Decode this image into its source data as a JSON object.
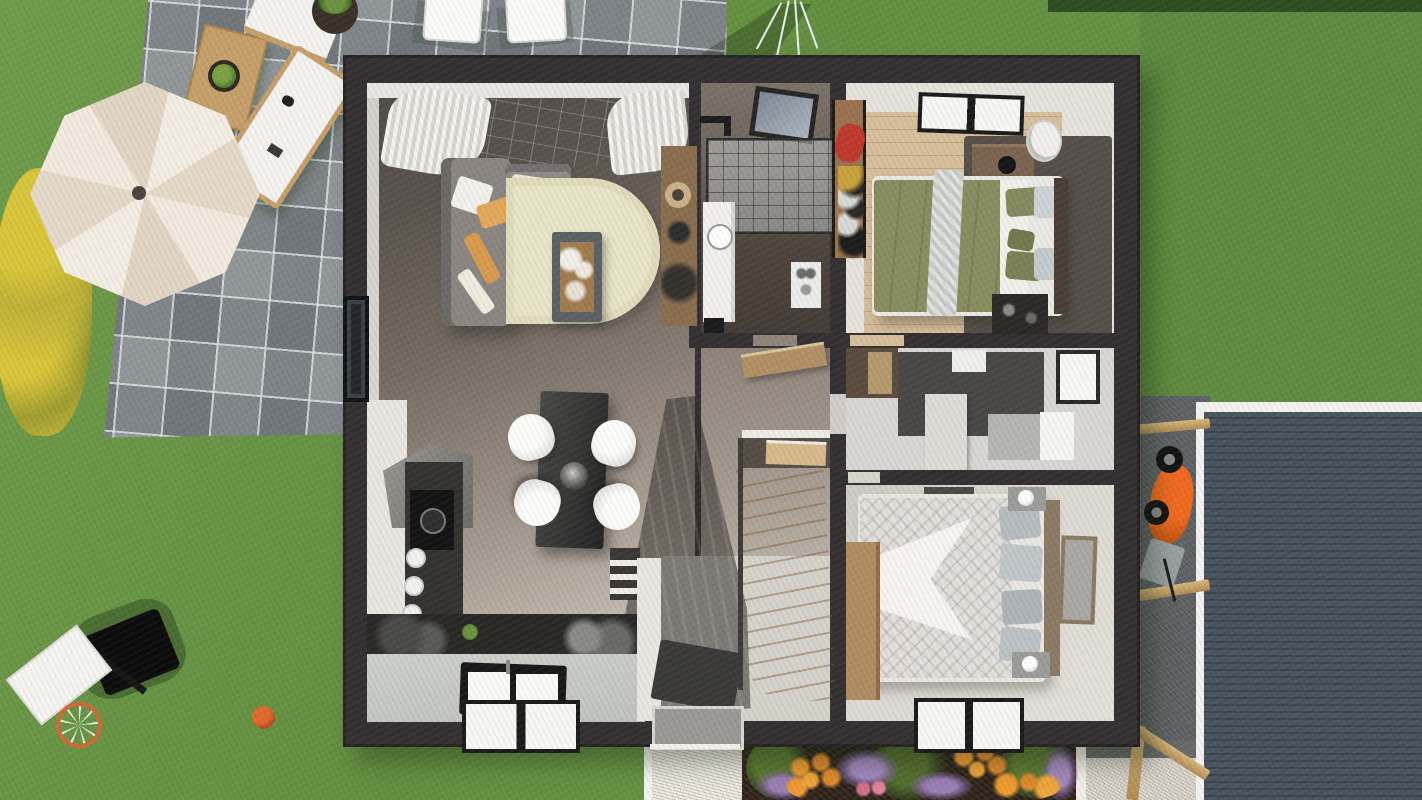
{
  "scene": {
    "type": "3d-floorplan-render",
    "view": "top-down",
    "palette": {
      "grass": "#6a974a",
      "hedge": "#2f4d22",
      "paver_gray": "#919699",
      "paver_grout": "#e1e5e8",
      "umbrella_cream": "#f2eade",
      "garden_wood": "#c6a06b",
      "bench_white": "#f4f3f0",
      "wall_charcoal": "#353132",
      "floor_dark_taupe": "#544e49",
      "floor_light": "#d2cdc3",
      "wood_floor": "#d7bf9b",
      "rug_beige": "#e9e5c8",
      "sofa_gray": "#8b8681",
      "cushion_orange": "#e3a85c",
      "bed_olive": "#8a8d60",
      "bed_white": "#e9e7e2",
      "pillow_gray_blue": "#c0c6c9",
      "counter_dark": "#2b2927",
      "countertop_gray": "#c4c7c2",
      "stairs_wood": "#e5cda6",
      "roof_slate": "#46505a",
      "driveway_gray": "#5e6163",
      "gravel_light": "#d6d0c6",
      "path_white": "#ece8df",
      "soil_brown": "#382c21",
      "flower_orange": "#e08a2e",
      "flower_purple": "#9a7fb5",
      "flower_yellow": "#d9c53a",
      "leaf_green": "#55702f",
      "wheelbarrow_orange": "#ef6a1f",
      "basketball_orange": "#d4622a"
    },
    "exterior_objects": [
      "paver-patio",
      "cream-parasol",
      "wooden-garden-table",
      "potted-plant",
      "white-garden-bench",
      "white-garden-bench-diagonal",
      "white-patio-chairs",
      "rotary-clothes-dryer",
      "yellow-flower-bush",
      "lawn",
      "basketball-hoop",
      "basketball",
      "hedge",
      "gravel-driveway",
      "timber-carport-beams",
      "corrugated-slate-roof",
      "orange-wheelbarrow",
      "white-gravel-path",
      "flower-bed-orange-purple"
    ],
    "house_rooms": [
      {
        "name": "living-room",
        "objects": [
          "glass-window-wall",
          "curtains",
          "corner-sofa",
          "cushions",
          "oval-rug",
          "coffee-table",
          "sideboard",
          "side-window"
        ]
      },
      {
        "name": "bathroom",
        "objects": [
          "skylight",
          "walk-in-shower",
          "shower-head",
          "vanity-basin",
          "appliance",
          "dark-mat"
        ]
      },
      {
        "name": "bedroom-1",
        "objects": [
          "window",
          "open-wardrobe",
          "red-clothes",
          "shoes",
          "dresser",
          "laundry-basket",
          "double-bed-olive",
          "gray-throw",
          "pillows",
          "dark-rug",
          "desk"
        ]
      },
      {
        "name": "hallway",
        "objects": [
          "console-table",
          "staircase",
          "stair-shadow"
        ]
      },
      {
        "name": "shower-room",
        "objects": [
          "window",
          "partition",
          "gray-vanity",
          "white-vanity",
          "dark-tile-floor"
        ]
      },
      {
        "name": "bedroom-2",
        "objects": [
          "double-bed-gray-pattern",
          "pillows",
          "nightstand-lamps",
          "wood-headboard",
          "wardrobe",
          "leaning-picture-frame",
          "window",
          "storage-benches"
        ]
      },
      {
        "name": "kitchen",
        "objects": [
          "extractor-hood",
          "dark-counter",
          "hob-with-pot",
          "stools",
          "back-counter-items",
          "light-countertop",
          "double-sink",
          "window",
          "small-plant"
        ]
      },
      {
        "name": "dining-area",
        "objects": [
          "dark-dining-table",
          "white-chair-1",
          "white-chair-2",
          "white-chair-3",
          "white-chair-4",
          "pendant-lamp"
        ]
      },
      {
        "name": "entry",
        "objects": [
          "slatted-divider",
          "white-partition-wall",
          "doormat",
          "front-door",
          "threshold"
        ]
      }
    ]
  }
}
